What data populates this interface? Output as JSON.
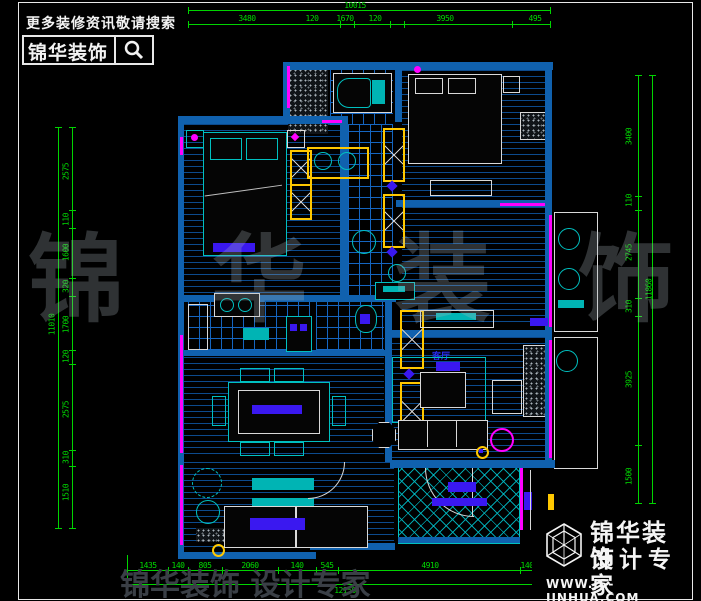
{
  "header": {
    "tagline": "更多装修资讯敬请搜索",
    "brand": "锦华装饰",
    "search_icon": "magnifier-icon"
  },
  "dims": {
    "top": {
      "total": "10015",
      "segments": [
        "3480",
        "120",
        "1670",
        "120",
        "3950",
        "495"
      ]
    },
    "bottom": {
      "total": "12150",
      "segments": [
        "1435",
        "140",
        "805",
        "2060",
        "140",
        "545",
        "4910",
        "140",
        "1445"
      ]
    },
    "left": {
      "total": "11010",
      "segments": [
        "2575",
        "110",
        "1600",
        "320",
        "1700",
        "120",
        "2575",
        "310",
        "1510"
      ]
    },
    "right": {
      "total": "11860",
      "segments": [
        "3400",
        "110",
        "2745",
        "310",
        "3925",
        "1500"
      ]
    }
  },
  "plan": {
    "room_labels": {
      "living": "客厅"
    }
  },
  "watermark": {
    "chars": [
      "锦",
      "华",
      "装",
      "饰"
    ],
    "bottom_text": "锦华装饰 设计专家"
  },
  "footer": {
    "brand": "锦华装饰",
    "subtitle": "设计专家",
    "url": "WWW.JS-JINHUA.COM",
    "logo": "cube-hexagon-logo"
  },
  "colors": {
    "dim_green": "#00d400",
    "wall_blue": "#1061ae",
    "floor_line_blue": "#0c4a8c",
    "tile_blue": "#1565c0",
    "fixture_cyan": "#00c0c0",
    "window_magenta": "#ff00ff",
    "cabinet_yellow": "#ffc800",
    "label_blue": "#3a18f0",
    "line_white": "#d9d9d9"
  }
}
